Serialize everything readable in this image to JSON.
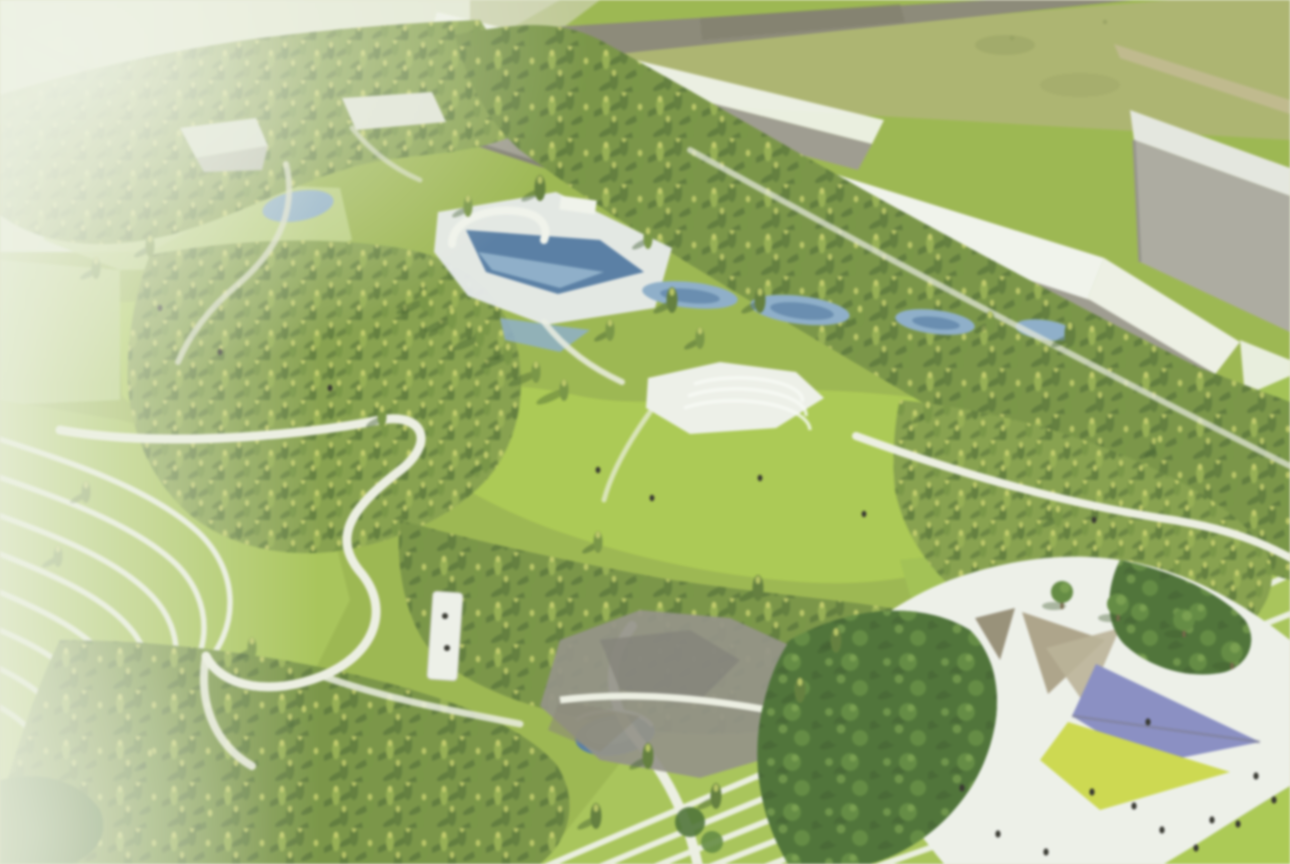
{
  "meta": {
    "kind": "aerial architectural rendering",
    "subject": "Park masterplan bird's-eye rendering: terraced lawns with white contour walkways, conifer woodland, blue water garden, large central lawn, gray industrial halls with white roofs along the top, olive field and perimeter road at top right, and a white event plaza with tan shade canopies, periwinkle and chartreuse ground panels at bottom right",
    "camera": "oblique bird's-eye view",
    "lighting": "soft daylight from upper right, shadows falling to lower left",
    "image_quality": "soft focus with hazy white glare along the left edge and top-left corner"
  },
  "counts": {
    "terrace_stripe_paths_left": 8,
    "terrace_stripe_lines_bottom_right": 7,
    "terrace_stripe_lines_right": 5,
    "shade_canopies": 3,
    "colored_ground_panels": 2,
    "visitor_dots_on_plaza": 12,
    "visitor_dots_on_lawns": 8
  },
  "palette": {
    "parkBase": "#96b53e",
    "lawnBright": "#a6c93f",
    "lawnMid": "#9cc041",
    "lawnPale": "#b9d276",
    "terraceGreen": "#a3c447",
    "stripeWhite": "#edf1e1",
    "pathWhite": "#eff1e4",
    "forestBase": "#7e9d3c",
    "forestBaseDark": "#6f8f35",
    "coniferDark": "#56772b",
    "coniferMid": "#6e9034",
    "coniferLight": "#8fac41",
    "coniferHighlight": "#c9d25e",
    "treeShadow": "#2f4f1c",
    "deciduousDark": "#3f6a26",
    "deciduousMid": "#568430",
    "deciduousHighlight": "#86b14a",
    "trunkBrown": "#6e5b39",
    "paleCorner": "#e7ebd5",
    "paleRoad": "#d3d7c1",
    "fieldOlive": "#a9b163",
    "fieldSmudge": "#8f9b52",
    "roadGray": "#85826f",
    "roadDark": "#76735f",
    "roadTan": "#c3b98c",
    "roofWhite": "#f4f6ef",
    "buildingGray": "#999689",
    "buildingDark": "#6e6b60",
    "buildingSide": "#a9a79c",
    "blockLight": "#e7e9e1",
    "deckWhite": "#e9edf0",
    "waterLight": "#85abcb",
    "waterDark": "#4a76a4",
    "plazaWhite": "#f0f2ec",
    "plazaGray": "#8d8b80",
    "plazaDark": "#7b7970",
    "canopyTan": "#ab9f82",
    "canopyGray": "#93896f",
    "periwinkle": "#8287c7",
    "chartreuse": "#ccd93a",
    "panelShadow": "#6e6e80",
    "peopleDark": "#26261f",
    "glare": "rgba(238,243,227,0.85)",
    "glareSoft": "rgba(240,244,230,0.9)",
    "washTint": "rgba(233,240,215,0.5)"
  }
}
